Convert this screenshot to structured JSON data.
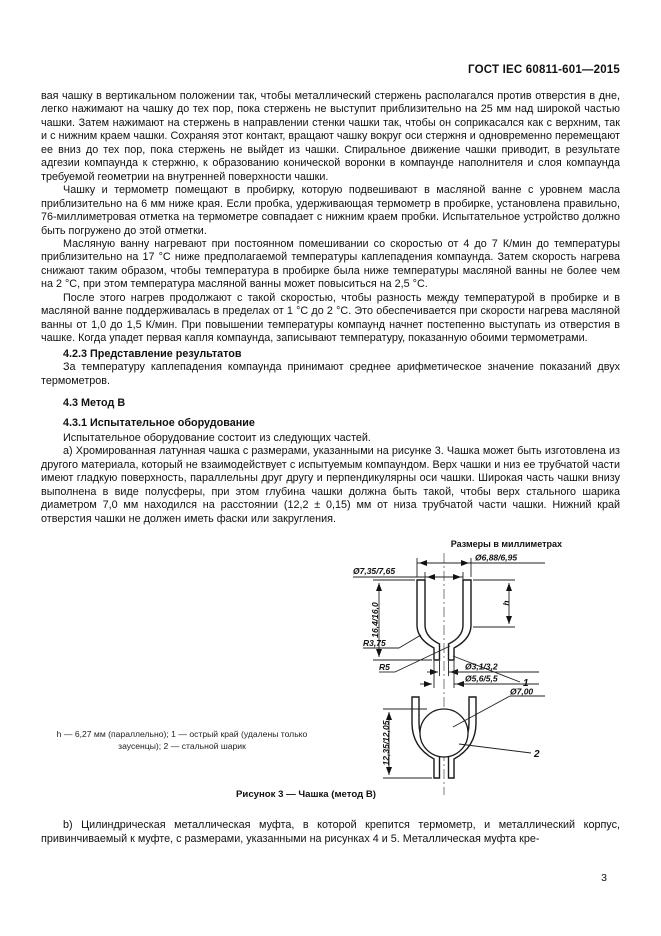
{
  "header": {
    "doc_code": "ГОСТ IEC 60811-601—2015"
  },
  "page_number": "3",
  "body": [
    {
      "text": "вая чашку в вертикальном положении так, чтобы металлический стержень располагался против отверстия в дне, легко нажимают на чашку до тех пор, пока стержень не выступит приблизительно на 25 мм над широкой частью чашки. Затем нажимают на стержень в направлении стенки чашки так, чтобы он соприкасался как с верхним, так и с нижним краем чашки. Сохраняя этот контакт, вращают чашку вокруг оси стержня и одновременно перемещают ее вниз до тех пор, пока стержень не выйдет из чашки. Спиральное движение чашки приводит, в результате адгезии компаунда к стержню, к образованию конической воронки в компаунде наполнителя и слоя компаунда требуемой геометрии на внутренней поверхности чашки."
    },
    {
      "text": "Чашку и термометр помещают в пробирку, которую подвешивают в масляной ванне с уровнем масла приблизительно на 6 мм ниже края. Если пробка, удерживающая термометр в пробирке, установлена правильно, 76-миллиметровая отметка на термометре совпадает с нижним краем пробки. Испытательное устройство должно быть погружено до этой отметки."
    },
    {
      "text": "Масляную ванну нагревают при постоянном помешивании со скоростью от 4 до 7 К/мин до температуры приблизительно на 17 °С ниже предполагаемой температуры каплепадения компаунда. Затем скорость нагрева снижают таким образом, чтобы температура в пробирке была ниже температуры масляной ванны не более чем на 2 °С, при этом температура масляной ванны может повыситься на 2,5 °С."
    },
    {
      "text": "После этого нагрев продолжают с такой скоростью, чтобы разность между температурой в пробирке и в масляной ванне поддерживалась в пределах от 1 °С до 2 °С. Это обеспечивается при скорости нагрева масляной ванны от 1,0 до 1,5 К/мин. При повышении температуры компаунд начнет постепенно выступать из отверстия в чашке. Когда упадет первая капля компаунда, записывают температуру, показанную обоими термометрами."
    },
    {
      "text": "4.2.3 Представление результатов"
    },
    {
      "text": "За температуру каплепадения компаунда принимают среднее арифметическое значение показаний двух термометров."
    },
    {
      "text": "4.3 Метод В"
    },
    {
      "text": "4.3.1 Испытательное оборудование"
    },
    {
      "text": "Испытательное оборудование состоит из следующих частей."
    },
    {
      "text": "а) Хромированная латунная чашка с размерами, указанными на рисунке 3. Чашка может быть изготовлена из другого материала, который не взаимодействует с испытуемым компаундом. Верх чашки и низ ее трубчатой части имеют гладкую поверхность, параллельны друг другу и перпендикулярны оси чашки. Широкая часть чашки внизу выполнена в виде полусферы, при этом глубина чашки должна быть такой, чтобы верх стального шарика диаметром 7,0 мм находился на расстоянии (12,2 ± 0,15) мм от низа трубчатой части чашки. Нижний край отверстия чашки не должен иметь фаски или закругления."
    },
    {
      "text": "b) Цилиндрическая металлическая муфта, в которой крепится термометр, и металлический корпус, привинчиваемый к муфте, с размерами, указанными на рисунках 4 и 5. Металлическая муфта кре-"
    }
  ],
  "figure": {
    "units_note": "Размеры в миллиметрах",
    "caption": "Рисунок 3 — Чашка (метод В)",
    "legend": {
      "part1": "h — 6,27 мм (параллельно); ",
      "part2": "1 — острый край (удалены только заусенцы); ",
      "part3": "2 — стальной шарик"
    },
    "dims": {
      "top_inner": "Ø6,88/6,95",
      "top_outer": "Ø7,35/7,65",
      "height": "16,4/16,0",
      "r_outer": "R3,75",
      "r_inner": "R5",
      "h": "h",
      "pointer1": "1",
      "hole_inner": "Ø3,1/3,2",
      "hole_outer": "Ø5,6/5,5",
      "depth": "12,35/12,05",
      "ball": "Ø7,00",
      "pointer2": "2"
    }
  }
}
